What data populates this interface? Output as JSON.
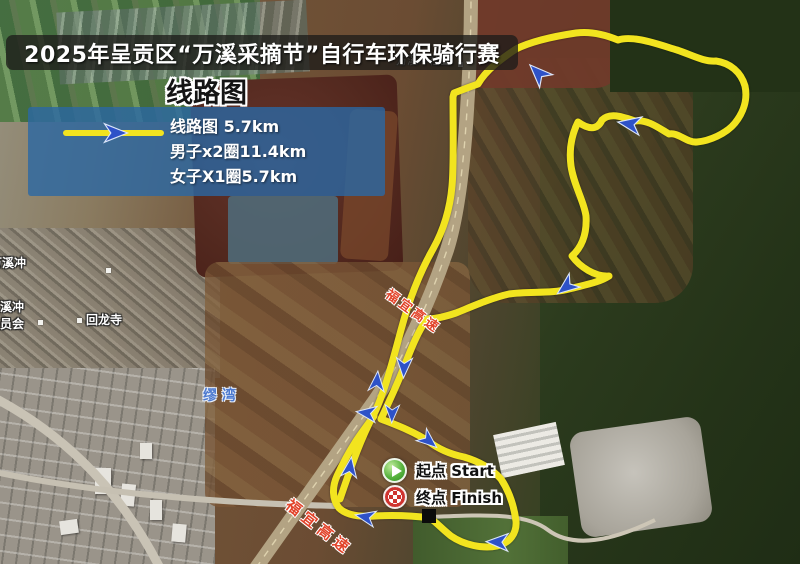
{
  "title": "2025年呈贡区“万溪采摘节”自行车环保骑行赛",
  "subtitle": "线路图",
  "legend": {
    "route": "线路图 5.7km",
    "men": "男子x2圈11.4km",
    "women": "女子X1圈5.7km"
  },
  "markers": {
    "start_label": "起点 Start",
    "finish_label": "终点 Finish"
  },
  "map_labels": {
    "community": "万溪冲社区",
    "village_nw": "万溪冲",
    "committee_line1": "万溪冲",
    "committee_line2": "委员会",
    "temple": "回龙寺",
    "village_blue": "缪 湾",
    "expressway": "福宜高速"
  },
  "colors": {
    "route_yellow": "#F2E41F",
    "arrow_blue": "#2E52C8",
    "legend_bg": "#2A68A4",
    "expressway_text": "#E2442B",
    "title_text": "#FFFFFF"
  }
}
